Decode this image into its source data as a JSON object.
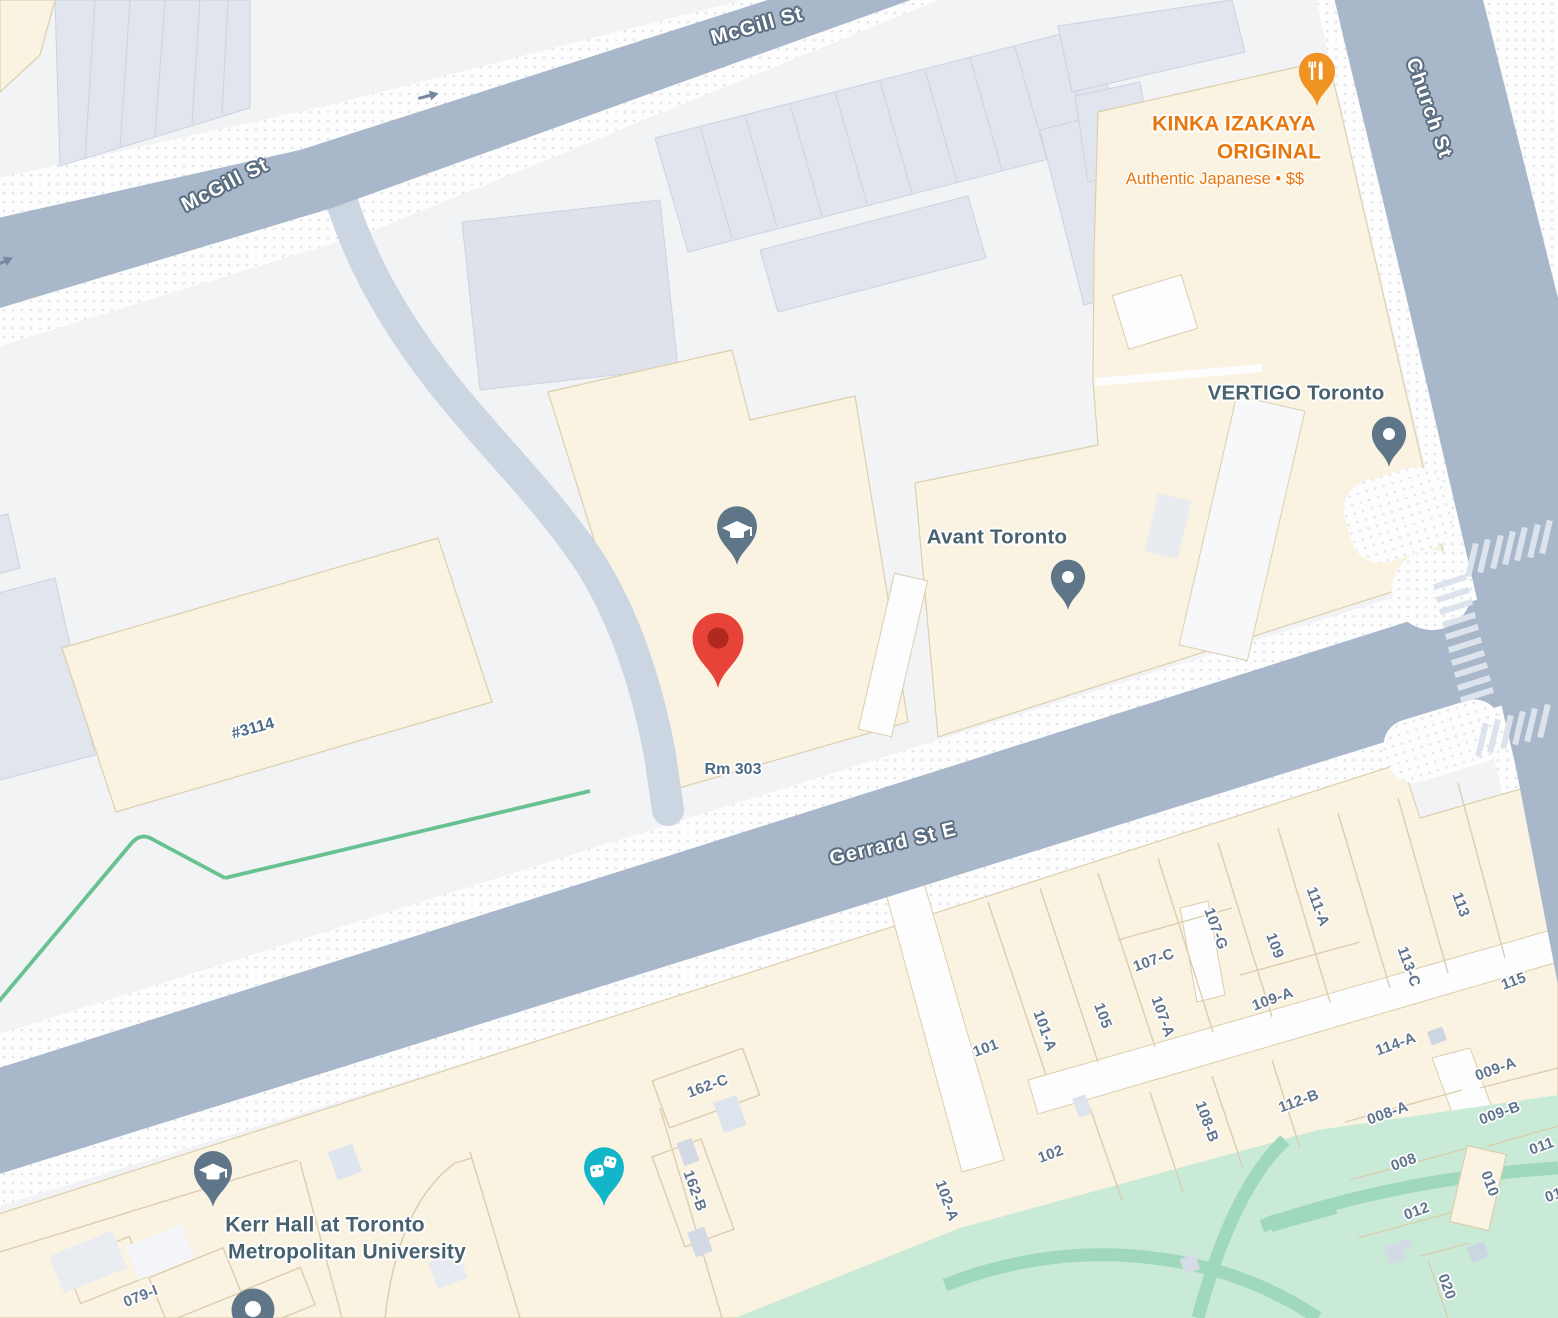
{
  "streets": {
    "mcgill": "McGill St",
    "church": "Church St",
    "gerrard": "Gerrard St E"
  },
  "pois": {
    "kinka": {
      "line1": "KINKA IZAKAYA",
      "line2": "ORIGINAL",
      "subtitle": "Authentic Japanese • $$"
    },
    "vertigo": "VERTIGO Toronto",
    "avant": "Avant Toronto",
    "kerr": {
      "line1": "Kerr Hall at Toronto",
      "line2": "Metropolitan University"
    },
    "rm": "Rm 303",
    "unit3114": "#3114"
  },
  "buildings": {
    "b101": "101",
    "b101a": "101-A",
    "b105": "105",
    "b107c": "107-C",
    "b107a": "107-A",
    "b107g": "107-G",
    "b109": "109",
    "b111a": "111-A",
    "b109a": "109-A",
    "b113": "113",
    "b113c": "113-C",
    "b115": "115",
    "b114a": "114-A",
    "b009a": "009-A",
    "b112b": "112-B",
    "b008a": "008-A",
    "b009b": "009-B",
    "b108b": "108-B",
    "b011": "011",
    "b102": "102",
    "b008": "008",
    "b010": "010",
    "b012": "012",
    "b020": "020",
    "b01partial": "01",
    "b162c": "162-C",
    "b162b": "162-B",
    "b102a": "102-A",
    "b079i": "079-I"
  },
  "icons": {
    "destination-marker": "red-pin",
    "education-pin": "graduation-cap",
    "restaurant-pin": "fork-and-knife",
    "theater-pin": "comedy-tragedy-masks",
    "place-pin": "dot-pin",
    "one-way-arrow": "arrow-right"
  },
  "colors": {
    "land": "#f1f3f5",
    "road": "#a8b7c9",
    "building_cream": "#faf3e2",
    "building_gray": "#e1e5ed",
    "park": "#c9ead7",
    "park_path": "#a0d8bb",
    "trail": "#68c191",
    "marker_red": "#e74338",
    "marker_red_inner": "#b0291e",
    "pin_slate": "#5f7689",
    "restaurant_orange": "#ef9423",
    "restaurant_text": "#e8770e",
    "theater_teal": "#13b5c8",
    "poi_label": "#47616f",
    "number_label": "#60748b",
    "street_label_outline": "#5b6d80"
  }
}
